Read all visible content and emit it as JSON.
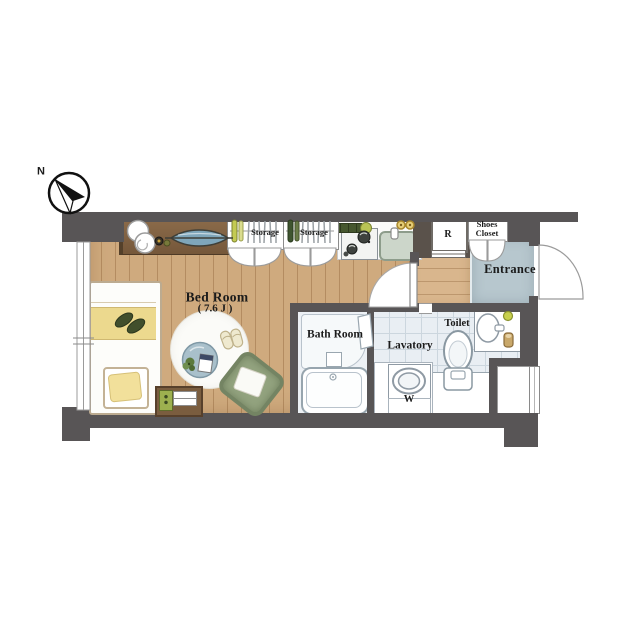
{
  "palette": {
    "wall_gray": "#585556",
    "wall_brown": "#5a524b",
    "bedroom_wood": "#cfaa7e",
    "hallway_wood": "#d9b68d",
    "counter_wood": "#7d6142",
    "entrance_floor": "#b7c7ce",
    "sanitary_tile": "#e9eef3",
    "bath_floor": "#edf1f5",
    "sink_green": "#ccd6ca",
    "bed_yellow": "#ecd98e",
    "cushion_green": "#93a37f",
    "hanger_yellow_green": "#c3ca52",
    "hanger_dark_green": "#3f5530",
    "decor_blue": "#7fa6ba"
  },
  "compass": {
    "north_label": "N"
  },
  "labels": {
    "bedroom_name": "Bed Room",
    "bedroom_size": "( 7.6 J )",
    "storage_left": "Storage",
    "storage_right": "Storage",
    "bath": "Bath Room",
    "lavatory": "Lavatory",
    "washing_machine": "W",
    "toilet": "Toilet",
    "entrance": "Entrance",
    "shoes_closet_line1": "Shoes",
    "shoes_closet_line2": "Closet",
    "refrigerator": "R"
  }
}
